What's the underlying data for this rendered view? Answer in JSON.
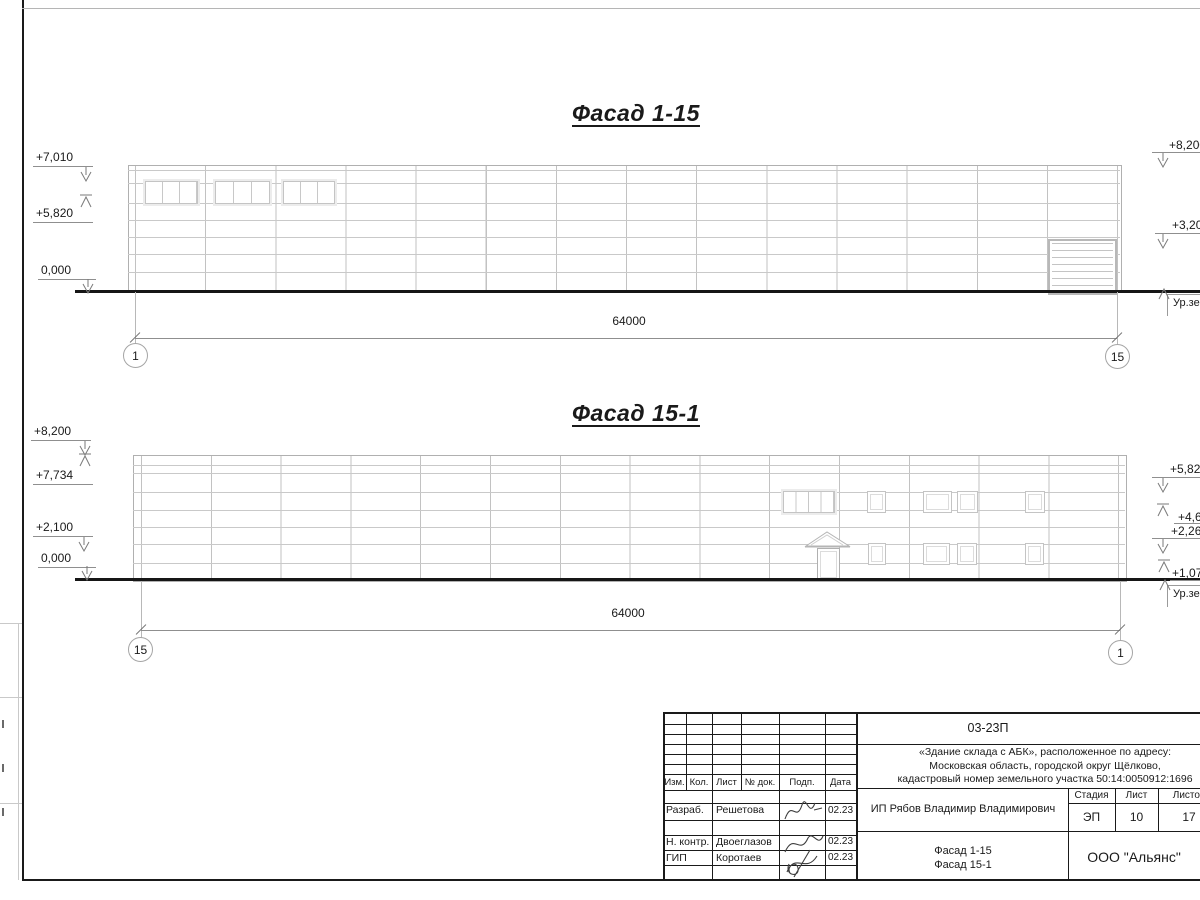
{
  "facade1": {
    "title": "Фасад 1-15",
    "dim_label": "64000",
    "axis_left": "1",
    "axis_right": "15",
    "mark_l1": "+7,010",
    "mark_l2": "+5,820",
    "mark_l3": "0,000",
    "mark_r1": "+8,200",
    "mark_r2": "+3,200",
    "ground_label": "Ур.земли"
  },
  "facade2": {
    "title": "Фасад 15-1",
    "dim_label": "64000",
    "axis_left": "15",
    "axis_right": "1",
    "mark_l1": "+8,200",
    "mark_l2": "+7,734",
    "mark_l3": "+2,100",
    "mark_l4": "0,000",
    "mark_r1": "+5,820",
    "mark_r2": "+4,630",
    "mark_r3": "+2,260",
    "mark_r4": "+1,070",
    "ground_label": "Ур.земли"
  },
  "titleblock": {
    "doc_number": "03-23П",
    "desc": [
      "«Здание склада с АБК», расположенное по адресу:",
      "Московская область, городской округ Щёлково,",
      "кадастровый номер земельного участка 50:14:0050912:1696"
    ],
    "change_header": {
      "izm": "Изм.",
      "kol": "Кол.",
      "list": "Лист",
      "doc": "№ док.",
      "podp": "Подп.",
      "data": "Дата"
    },
    "rows": [
      {
        "role": "Разраб.",
        "name": "Решетова",
        "date": "02.23"
      },
      {
        "role": "Н. контр.",
        "name": "Двоеглазов",
        "date": "02.23"
      },
      {
        "role": "ГИП",
        "name": "Коротаев",
        "date": "02.23"
      }
    ],
    "client": "ИП Рябов Владимир Владимирович",
    "stage_label": "Стадия",
    "list_label": "Лист",
    "listov_label": "Листов",
    "stage": "ЭП",
    "sheet": "10",
    "total": "17",
    "sheet_name": [
      "Фасад 1-15",
      "Фасад 15-1"
    ],
    "org": "ООО \"Альянс\""
  }
}
